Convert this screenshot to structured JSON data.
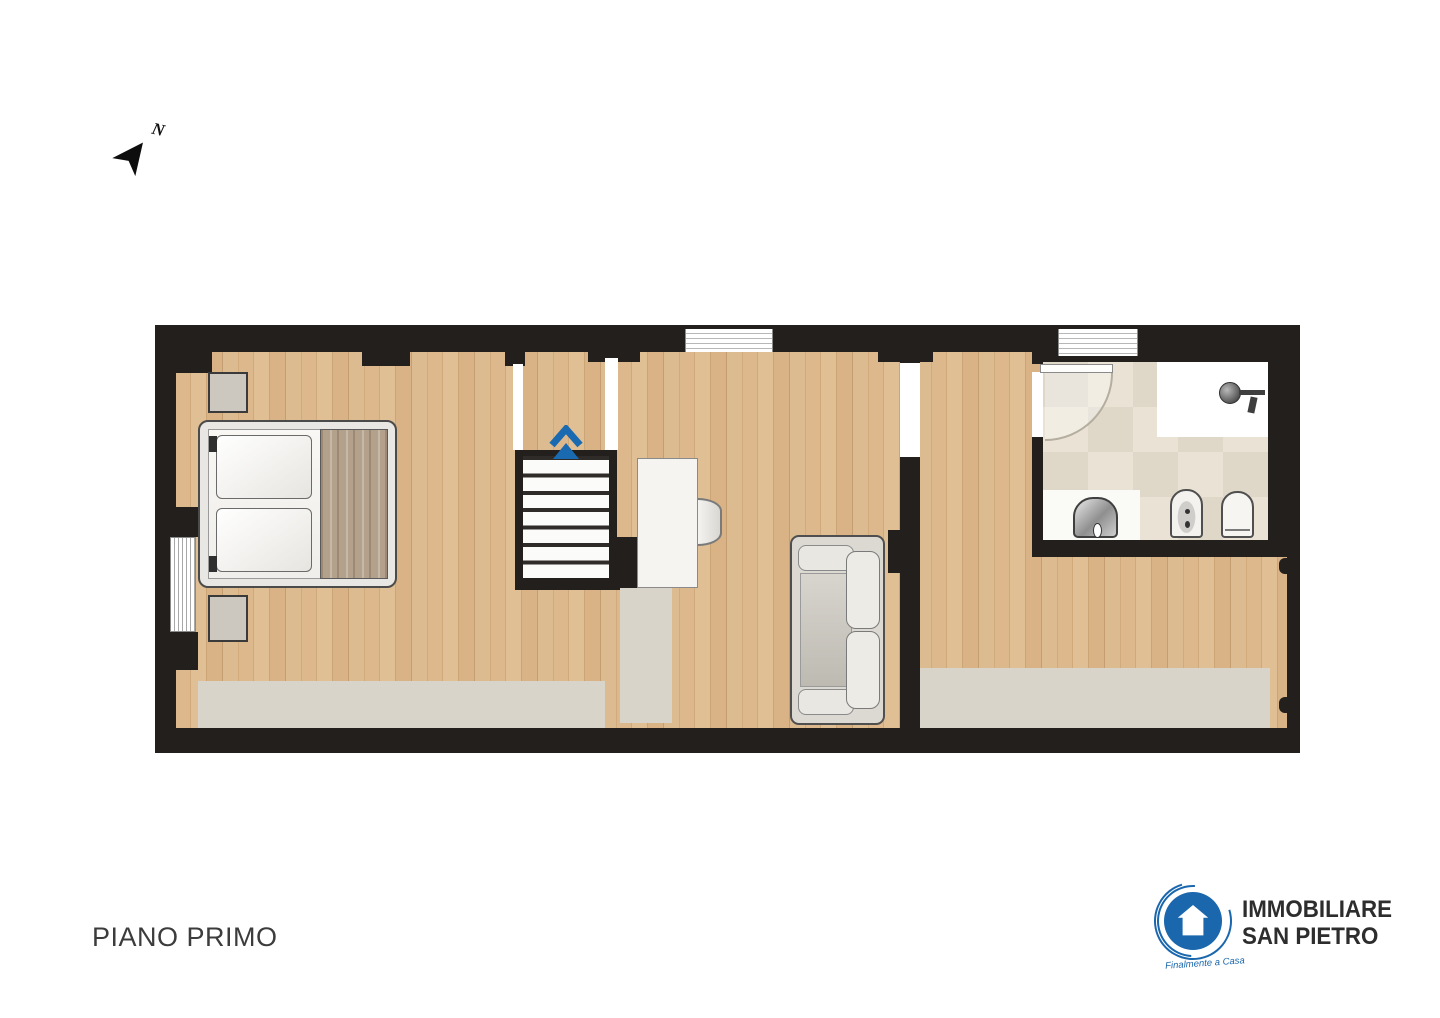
{
  "colors": {
    "wall": "#221f1d",
    "wood": "#d8b287",
    "rug": "#d8d4ca",
    "tile": "#e4ddcf",
    "opening": "#ffffff",
    "arrow": "#1a6ab1",
    "brand": "#1a67ad",
    "text": "#3c3c3c",
    "brandtext": "#2d2d2d",
    "counter": "#fafaf7",
    "blanket": "#b3a18c",
    "sofa": "#dcd9d3",
    "furngray": "#ccc7bf",
    "tread": "#fbfbfa"
  },
  "compass": {
    "label": "N"
  },
  "floor_plan": {
    "stairs": {
      "steps": 7,
      "direction_arrow_color": "#1a6ab1"
    },
    "windows_top_wall": 2,
    "bathroom_fixtures": [
      "shower",
      "shower-head",
      "sink",
      "bidet",
      "toilet"
    ],
    "furniture": [
      "double-bed",
      "nightstand",
      "nightstand",
      "desk",
      "chair",
      "sofa",
      "radiator"
    ]
  },
  "footer": {
    "floor_label": "PIANO PRIMO"
  },
  "logo": {
    "line1": "IMMOBILIARE",
    "line2": "SAN PIETRO",
    "tagline": "Finalmente a Casa"
  }
}
